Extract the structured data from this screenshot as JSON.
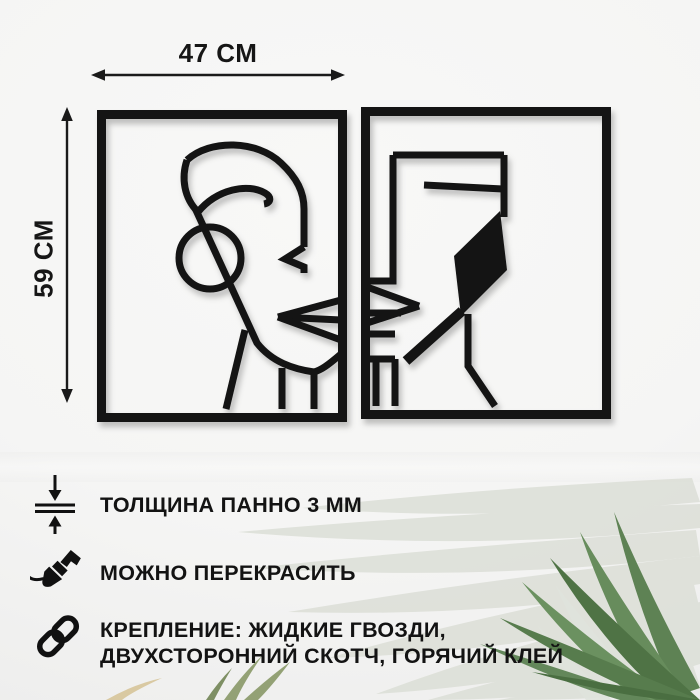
{
  "page_type": "product-infographic",
  "dimensions": {
    "width_label": "47 СМ",
    "height_label": "59 СМ"
  },
  "artwork": {
    "panels": 2,
    "style": "abstract one-line face panels, black metal on white wall",
    "left_panel": "line-art half face with circle earring and lips at right edge",
    "right_panel": "line-art half face with black filled hair shape and lips at left edge"
  },
  "features": [
    {
      "icon": "thickness-icon",
      "lines": [
        "ТОЛЩИНА ПАННО 3 ММ"
      ]
    },
    {
      "icon": "paintbrush-icon",
      "lines": [
        "МОЖНО ПЕРЕКРАСИТЬ"
      ]
    },
    {
      "icon": "chain-link-icon",
      "lines": [
        "КРЕПЛЕНИЕ: ЖИДКИЕ ГВОЗДИ,",
        "ДВУХСТОРОННИЙ СКОТЧ, ГОРЯЧИЙ КЛЕЙ"
      ]
    }
  ],
  "colors": {
    "background": "#f5f5f4",
    "ink": "#141414",
    "leaf_pale": "#dcdfd7",
    "leaf_dark_green": "#5d8054",
    "leaf_olive": "#93a175",
    "leaf_tan": "#d9c9a2"
  }
}
